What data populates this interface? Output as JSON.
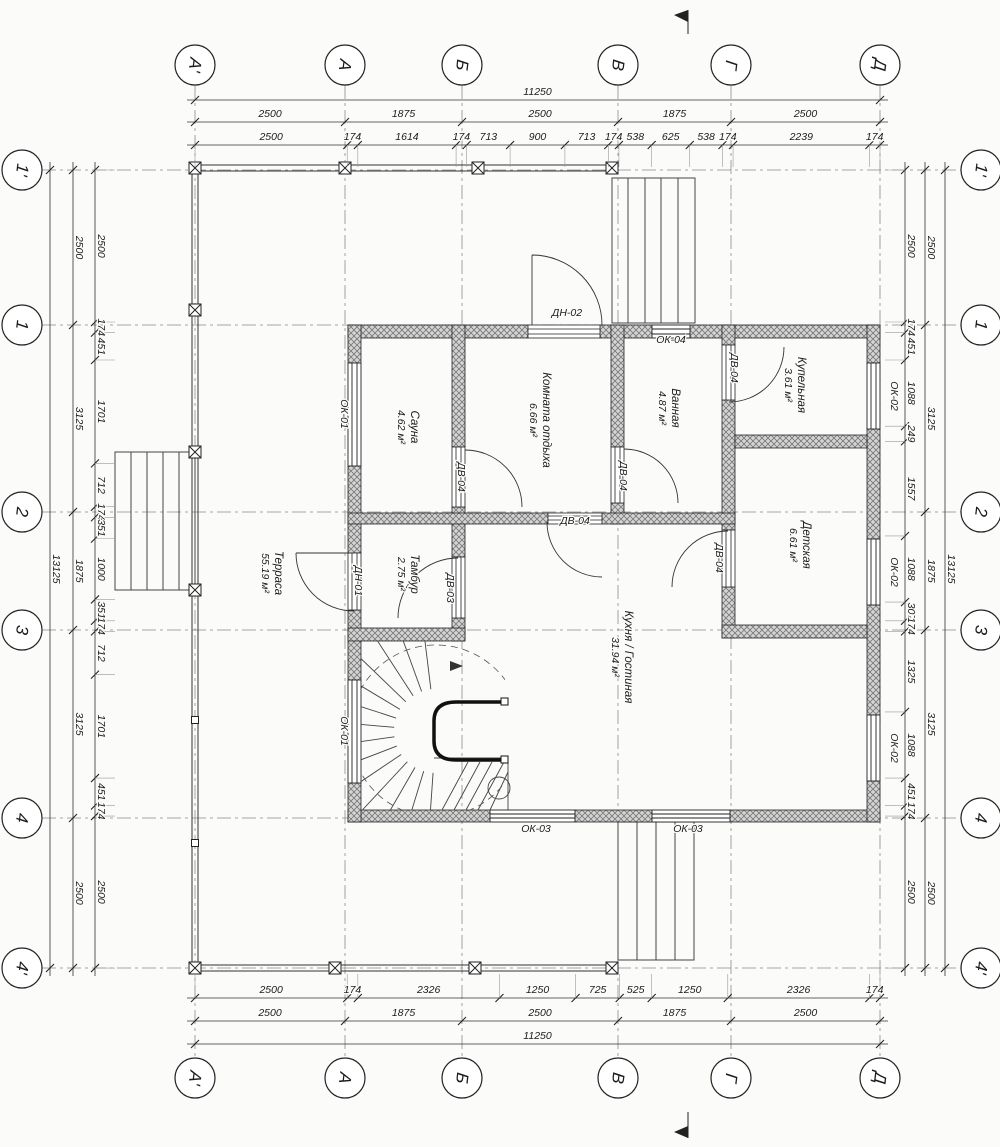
{
  "drawing": {
    "axes": {
      "cols": [
        {
          "label": "А'",
          "x": 195
        },
        {
          "label": "А",
          "x": 345
        },
        {
          "label": "Б",
          "x": 462
        },
        {
          "label": "В",
          "x": 618
        },
        {
          "label": "Г",
          "x": 731
        },
        {
          "label": "Д",
          "x": 880
        }
      ],
      "rows": [
        {
          "label": "1'",
          "y": 170
        },
        {
          "label": "1",
          "y": 325
        },
        {
          "label": "2",
          "y": 512
        },
        {
          "label": "3",
          "y": 630
        },
        {
          "label": "4",
          "y": 818
        },
        {
          "label": "4'",
          "y": 968
        }
      ]
    },
    "dimensions": {
      "top": {
        "total": 11250,
        "spans": [
          2500,
          1875,
          2500,
          1875,
          2500
        ],
        "detail": [
          2500,
          174,
          1614,
          174,
          713,
          900,
          713,
          174,
          538,
          625,
          538,
          174,
          2239,
          174
        ]
      },
      "bottom": {
        "total": 11250,
        "spans": [
          2500,
          1875,
          2500,
          1875,
          2500
        ],
        "detail": [
          2500,
          174,
          2326,
          1250,
          725,
          525,
          1250,
          2326,
          174
        ]
      },
      "left": {
        "total": 13125,
        "spans": [
          2500,
          3125,
          1875,
          3125,
          2500
        ],
        "detail": [
          2500,
          174,
          451,
          1701,
          712,
          174,
          351,
          1000,
          351,
          174,
          712,
          1701,
          451,
          174,
          2500
        ]
      },
      "right": {
        "total": 13125,
        "spans": [
          2500,
          3125,
          1875,
          3125,
          2500
        ],
        "detail": [
          2500,
          174,
          451,
          1088,
          249,
          1557,
          1088,
          307,
          174,
          1325,
          1088,
          451,
          174,
          2500
        ]
      }
    },
    "rooms": [
      {
        "name": "Сауна",
        "area": "4.62 м²",
        "x": 408,
        "y": 427
      },
      {
        "name": "Комната отдыха",
        "area": "6.66 м²",
        "x": 540,
        "y": 420
      },
      {
        "name": "Ванная",
        "area": "4.87 м²",
        "x": 669,
        "y": 408
      },
      {
        "name": "Купельная",
        "area": "3.61 м²",
        "x": 795,
        "y": 385
      },
      {
        "name": "Детская",
        "area": "6.61 м²",
        "x": 800,
        "y": 545
      },
      {
        "name": "Тамбур",
        "area": "2.75 м²",
        "x": 408,
        "y": 574
      },
      {
        "name": "Кухня / Гостиная",
        "area": "31.94 м²",
        "x": 622,
        "y": 657
      },
      {
        "name": "Терраса",
        "area": "55.19 м²",
        "x": 272,
        "y": 573
      }
    ],
    "tags": [
      {
        "text": "ДН-02",
        "x": 567,
        "y": 316,
        "r": 0
      },
      {
        "text": "ОК-04",
        "x": 671,
        "y": 343,
        "r": 0
      },
      {
        "text": "ДВ-04",
        "x": 731,
        "y": 368,
        "r": 90
      },
      {
        "text": "ОК-02",
        "x": 891,
        "y": 396,
        "r": 90
      },
      {
        "text": "ОК-01",
        "x": 341,
        "y": 414,
        "r": 90
      },
      {
        "text": "ДВ-04",
        "x": 458,
        "y": 477,
        "r": 90
      },
      {
        "text": "ДВ-04",
        "x": 620,
        "y": 476,
        "r": 90
      },
      {
        "text": "ДВ-04",
        "x": 575,
        "y": 524,
        "r": 0
      },
      {
        "text": "ОК-02",
        "x": 891,
        "y": 572,
        "r": 90
      },
      {
        "text": "ДВ-04",
        "x": 716,
        "y": 558,
        "r": 90
      },
      {
        "text": "ДН-01",
        "x": 355,
        "y": 581,
        "r": 90
      },
      {
        "text": "ДВ-03",
        "x": 447,
        "y": 588,
        "r": 90
      },
      {
        "text": "ОК-01",
        "x": 341,
        "y": 731,
        "r": 90
      },
      {
        "text": "ОК-02",
        "x": 891,
        "y": 748,
        "r": 90
      },
      {
        "text": "ОК-03",
        "x": 536,
        "y": 832,
        "r": 0
      },
      {
        "text": "ОК-03",
        "x": 688,
        "y": 832,
        "r": 0
      }
    ],
    "colors": {
      "wall_fill": "#d4d4d4",
      "wall_hatch": "#777777",
      "line": "#222222",
      "axis": "#8a8a8a"
    }
  }
}
